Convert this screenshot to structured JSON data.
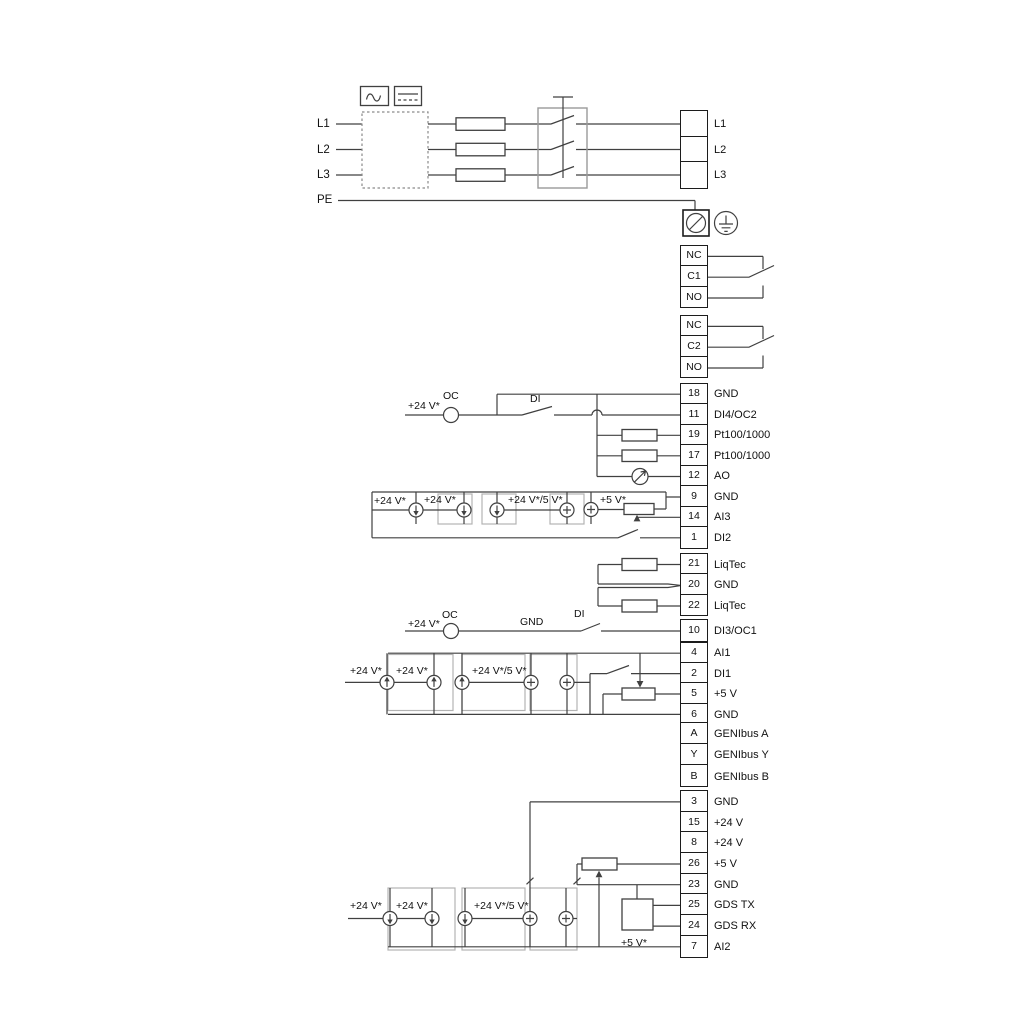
{
  "labels": {
    "v24": "+24 V*",
    "v24_5": "+24 V*/5 V*",
    "v5": "+5 V*",
    "oc": "OC",
    "di": "DI",
    "gnd": "GND",
    "l1": "L1",
    "l2": "L2",
    "l3": "L3",
    "pe": "PE"
  },
  "terminals": {
    "mains": [
      {
        "label": "L1"
      },
      {
        "label": "L2"
      },
      {
        "label": "L3"
      }
    ],
    "relay1": [
      "NC",
      "C1",
      "NO"
    ],
    "relay2": [
      "NC",
      "C2",
      "NO"
    ],
    "io1": [
      {
        "no": "18",
        "label": "GND"
      },
      {
        "no": "11",
        "label": "DI4/OC2"
      },
      {
        "no": "19",
        "label": "Pt100/1000"
      },
      {
        "no": "17",
        "label": "Pt100/1000"
      },
      {
        "no": "12",
        "label": "AO"
      },
      {
        "no": "9",
        "label": "GND"
      },
      {
        "no": "14",
        "label": "AI3"
      },
      {
        "no": "1",
        "label": "DI2"
      }
    ],
    "liqtec": [
      {
        "no": "21",
        "label": "LiqTec"
      },
      {
        "no": "20",
        "label": "GND"
      },
      {
        "no": "22",
        "label": "LiqTec"
      }
    ],
    "di3": [
      {
        "no": "10",
        "label": "DI3/OC1"
      }
    ],
    "io2": [
      {
        "no": "4",
        "label": "AI1"
      },
      {
        "no": "2",
        "label": "DI1"
      },
      {
        "no": "5",
        "label": "+5 V"
      },
      {
        "no": "6",
        "label": "GND"
      }
    ],
    "genibus": [
      {
        "no": "A",
        "label": "GENIbus A"
      },
      {
        "no": "Y",
        "label": "GENIbus Y"
      },
      {
        "no": "B",
        "label": "GENIbus B"
      }
    ],
    "io3": [
      {
        "no": "3",
        "label": "GND"
      },
      {
        "no": "15",
        "label": "+24 V"
      },
      {
        "no": "8",
        "label": "+24 V"
      },
      {
        "no": "26",
        "label": "+5 V"
      },
      {
        "no": "23",
        "label": "GND"
      },
      {
        "no": "25",
        "label": "GDS TX"
      },
      {
        "no": "24",
        "label": "GDS RX"
      },
      {
        "no": "7",
        "label": "AI2"
      }
    ]
  }
}
